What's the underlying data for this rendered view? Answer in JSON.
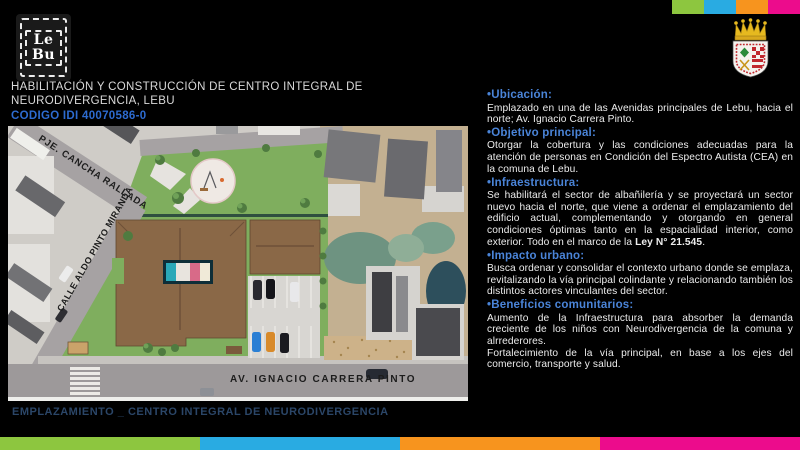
{
  "palette": {
    "green": "#8dc63f",
    "blue": "#29abe2",
    "orange": "#f7941e",
    "pink": "#ec0c8c",
    "header_blue": "#4a84d8",
    "code_blue": "#2d6bd0",
    "caption_navy": "#2b4668"
  },
  "top_bar": {
    "squares": [
      {
        "label": "green-square",
        "color": "#8dc63f"
      },
      {
        "label": "blue-square",
        "color": "#29abe2"
      },
      {
        "label": "orange-square",
        "color": "#f7941e"
      },
      {
        "label": "pink-square",
        "color": "#ec0c8c"
      }
    ]
  },
  "bottom_bar": {
    "segments": [
      {
        "label": "green-segment",
        "color": "#8dc63f"
      },
      {
        "label": "blue-segment",
        "color": "#29abe2"
      },
      {
        "label": "orange-segment",
        "color": "#f7941e"
      },
      {
        "label": "pink-segment",
        "color": "#ec0c8c"
      }
    ]
  },
  "logo": {
    "line1": "Le",
    "line2": "Bu"
  },
  "header": {
    "title_line1": "HABILITACIÓN Y CONSTRUCCIÓN DE CENTRO INTEGRAL DE",
    "title_line2": "NEURODIVERGENCIA, LEBU",
    "code": "CODIGO IDI 40070586-0"
  },
  "site_plan": {
    "streets": [
      "PJE. CANCHA RALLADA",
      "CALLE ALDO PINTO MIRANDA",
      "AV. IGNACIO CARRERA PINTO"
    ],
    "caption": "EMPLAZAMIENTO _ CENTRO INTEGRAL DE NEURODIVERGENCIA"
  },
  "content": {
    "sections": [
      {
        "header": "•Ubicación:",
        "paragraphs": [
          [
            {
              "t": "Emplazado en una de las Avenidas principales de Lebu, hacia el norte; Av. Ignacio Carrera Pinto."
            }
          ]
        ]
      },
      {
        "header": "•Objetivo principal:",
        "paragraphs": [
          [
            {
              "t": "Otorgar la cobertura y las condiciones adecuadas para la atención de personas en Condición del Espectro Autista (CEA) en la comuna de Lebu."
            }
          ]
        ]
      },
      {
        "header": "•Infraestructura:",
        "paragraphs": [
          [
            {
              "t": "Se habilitará el sector de albañilería y se proyectará un sector nuevo hacia el norte, que viene a ordenar el emplazamiento del edificio actual, complementando y otorgando en general condiciones óptimas tanto en la espacialidad interior, como exterior. Todo en el marco de la "
            },
            {
              "t": "Ley N° 21.545",
              "b": true
            },
            {
              "t": "."
            }
          ]
        ]
      },
      {
        "header": "•Impacto urbano:",
        "paragraphs": [
          [
            {
              "t": "Busca ordenar y consolidar el contexto urbano donde se emplaza, revitalizando la vía principal colindante y relacionando también los distintos actores vinculantes del sector."
            }
          ]
        ]
      },
      {
        "header": "•Beneficios comunitarios:",
        "paragraphs": [
          [
            {
              "t": "Aumento de la Infraestructura para absorber la demanda creciente de los niños con Neurodivergencia de la comuna y alrrederores."
            }
          ],
          [
            {
              "t": "Fortalecimiento de la vía principal, en base a los ejes del comercio, transporte y salud."
            }
          ]
        ]
      }
    ]
  }
}
